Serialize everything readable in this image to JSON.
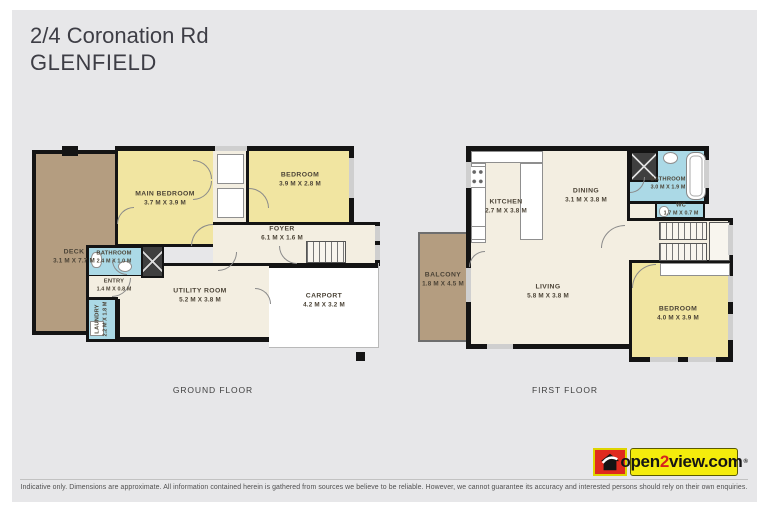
{
  "header": {
    "address": "2/4 Coronation Rd",
    "suburb": "GLENFIELD"
  },
  "floors": {
    "ground": {
      "label": "GROUND FLOOR",
      "rooms": {
        "deck": {
          "name": "DECK",
          "dims": "3.1 M X 7.7 M"
        },
        "main_bedroom": {
          "name": "MAIN BEDROOM",
          "dims": "3.7 M X 3.9 M"
        },
        "bedroom": {
          "name": "BEDROOM",
          "dims": "3.9 M X 2.8 M"
        },
        "foyer": {
          "name": "FOYER",
          "dims": "6.1 M X 1.6 M"
        },
        "bathroom": {
          "name": "BATHROOM",
          "dims": "2.4 M X 1.0 M"
        },
        "entry": {
          "name": "ENTRY",
          "dims": "1.4 M X 0.8 M"
        },
        "laundry": {
          "name": "LAUNDRY",
          "dims": "2.2 M X 1.8 M"
        },
        "utility": {
          "name": "UTILITY ROOM",
          "dims": "5.2 M X 3.8 M"
        },
        "carport": {
          "name": "CARPORT",
          "dims": "4.2 M X 3.2 M"
        }
      }
    },
    "first": {
      "label": "FIRST FLOOR",
      "rooms": {
        "balcony": {
          "name": "BALCONY",
          "dims": "1.8 M X 4.5 M"
        },
        "kitchen": {
          "name": "KITCHEN",
          "dims": "2.7 M X 3.8 M"
        },
        "dining": {
          "name": "DINING",
          "dims": "3.1 M X 3.8 M"
        },
        "bathroom": {
          "name": "BATHROOM",
          "dims": "3.0 M X 1.9 M"
        },
        "wc": {
          "name": "WC",
          "dims": "1.7 M X 0.7 M"
        },
        "living": {
          "name": "LIVING",
          "dims": "5.8 M X 3.8 M"
        },
        "bedroom": {
          "name": "BEDROOM",
          "dims": "4.0 M X 3.9 M"
        }
      }
    }
  },
  "footer": {
    "disclaimer": "Indicative only. Dimensions are approximate. All information contained herein is gathered from sources we believe to be reliable. However, we cannot guarantee its accuracy and interested persons should rely on their own enquiries."
  },
  "logo": {
    "pre": "open",
    "num": "2",
    "post": "view.com",
    "registered": "®"
  },
  "colors": {
    "brand_red": "#e02a1e",
    "brand_yellow": "#f4ec0c",
    "bedroom_fill": "#f1e5a1",
    "wet_area_fill": "#abd9e6",
    "deck_fill": "#b49d80",
    "room_fill": "#f3eee1",
    "wall": "#141414",
    "background": "#e7e7e9"
  }
}
